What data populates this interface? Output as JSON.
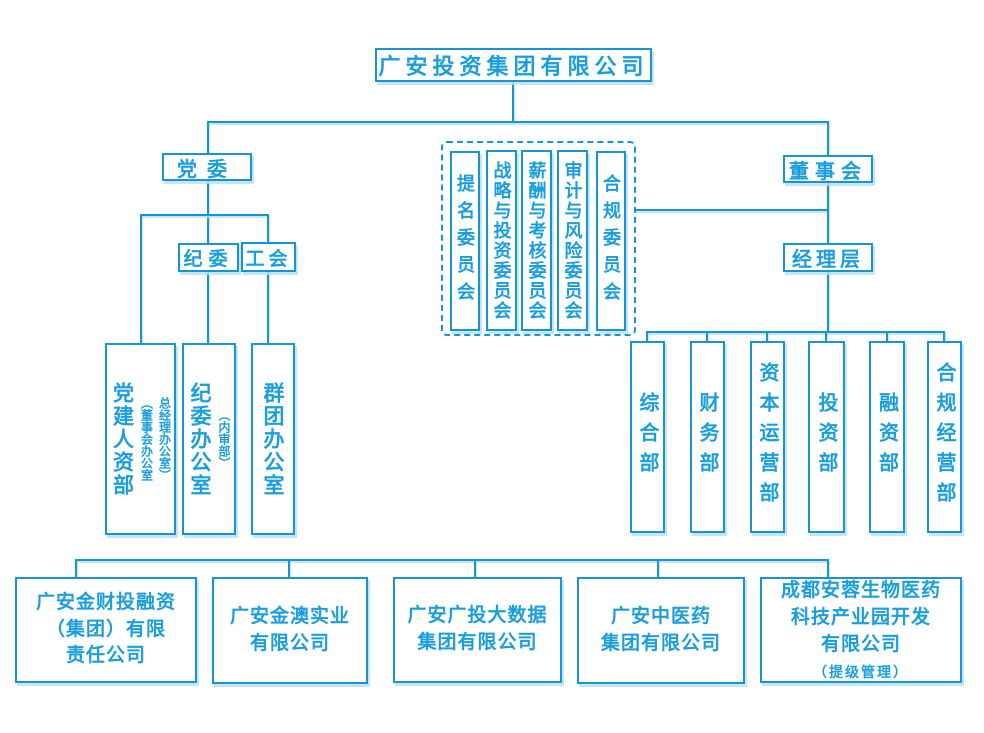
{
  "title": "广安投资集团有限公司",
  "party": {
    "dangwei": "党委",
    "jiwei": "纪委",
    "gonghui": "工会"
  },
  "offices": [
    {
      "main": "党建人资部",
      "notes": [
        "（董事会办公室",
        "总经理办公室）"
      ]
    },
    {
      "main": "纪委办公室",
      "notes": [
        "（内审部）"
      ]
    },
    {
      "main": "群团办公室",
      "notes": []
    }
  ],
  "committees": [
    "提名委员会",
    "战略与投资委员会",
    "薪酬与考核委员会",
    "审计与风险委员会",
    "合规委员会"
  ],
  "board": {
    "dongshihui": "董事会",
    "jingliceng": "经理层"
  },
  "departments": [
    "综合部",
    "财务部",
    "资本运营部",
    "投资部",
    "融资部",
    "合规经营部"
  ],
  "subsidiaries": [
    {
      "name": "广安金财投融资\n（集团）有限\n责任公司"
    },
    {
      "name": "广安金澳实业\n有限公司"
    },
    {
      "name": "广安广投大数据\n集团有限公司"
    },
    {
      "name": "广安中医药\n集团有限公司"
    },
    {
      "name": "成都安蓉生物医药\n科技产业园开发\n有限公司",
      "note": "（提级管理）"
    }
  ],
  "colors": {
    "line": "#1795d2",
    "text": "#1b9edb",
    "shadow": "#b5e0f5"
  }
}
